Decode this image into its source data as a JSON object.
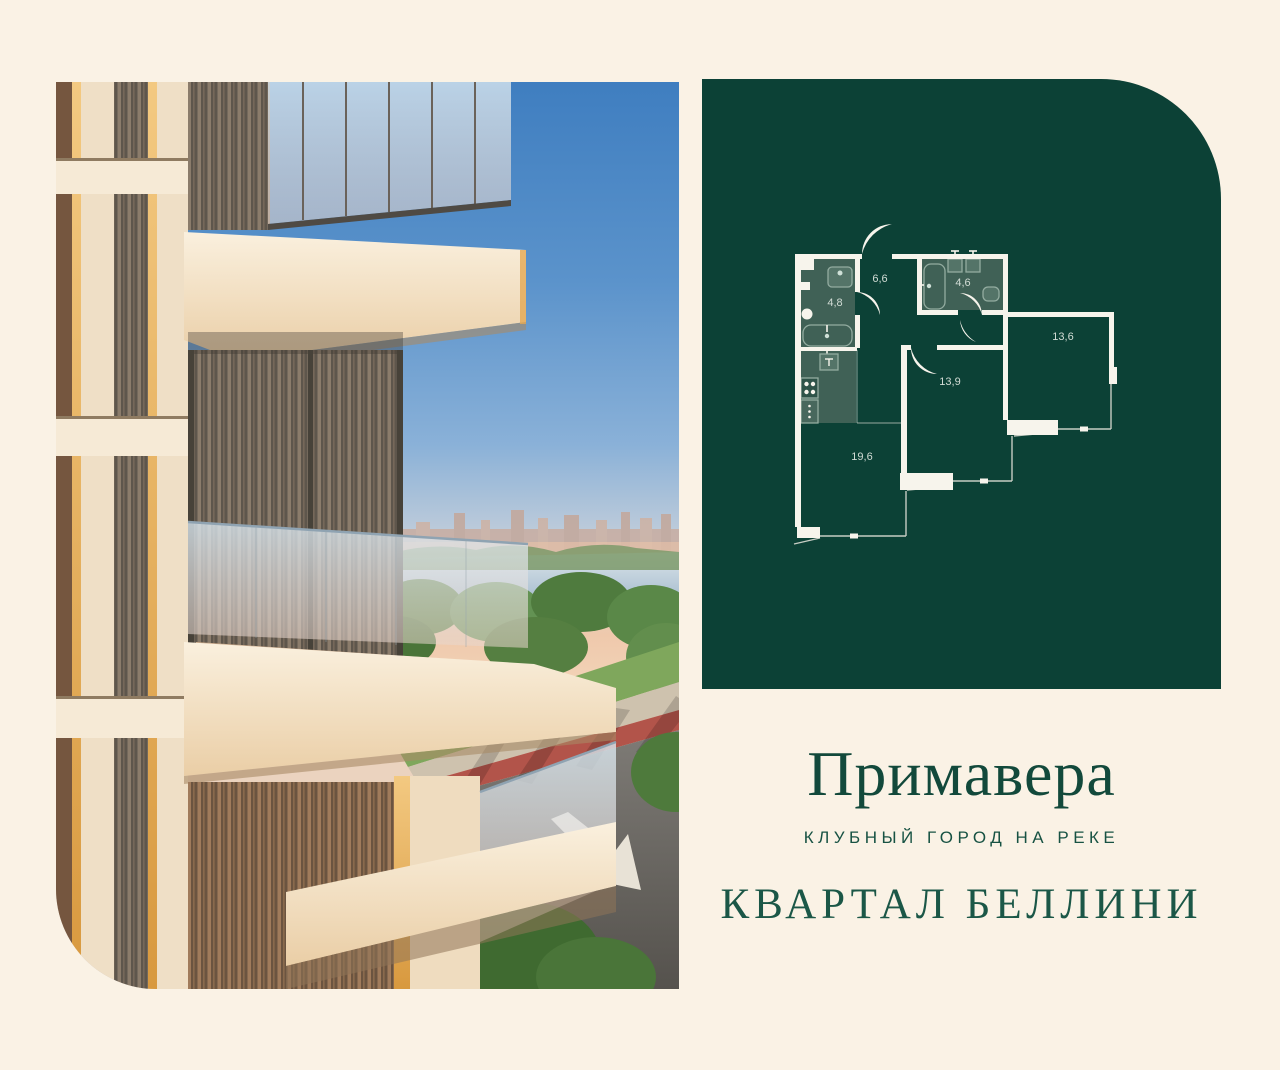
{
  "page": {
    "background_color": "#FAF2E5"
  },
  "branding": {
    "project_name": "Примавера",
    "tagline": "КЛУБНЫЙ ГОРОД НА РЕКЕ",
    "quarter_name": "КВАРТАЛ БЕЛЛИНИ",
    "title_color": "#12493B"
  },
  "floorplan": {
    "panel_color": "#0C4136",
    "wall_color": "#F7F4EC",
    "wet_zone_color": "#406156",
    "room_label_color": "#D2DCD5",
    "rooms": [
      "6,6",
      "4,8",
      "4,6",
      "13,6",
      "13,9",
      "19,6"
    ]
  }
}
